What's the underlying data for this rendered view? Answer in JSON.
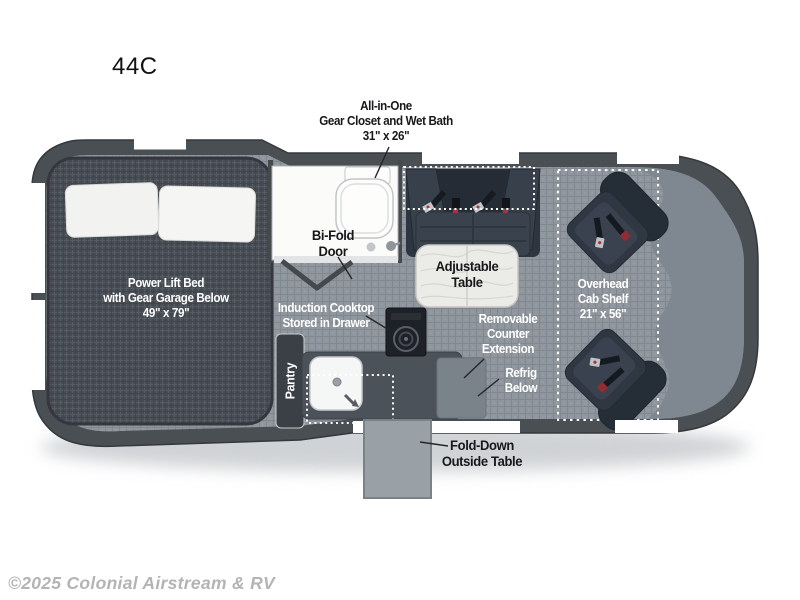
{
  "plan_code": "44C",
  "watermark": {
    "text": "©2025 Colonial Airstream & RV"
  },
  "colors": {
    "van_body": "#4a4f54",
    "floor": "#8f969e",
    "bed": "#474c53",
    "furniture_dark": "#2f3742",
    "bath_white": "#fbfbfa",
    "table_light": "#ebebe8",
    "label_white": "#ffffff",
    "label_dark": "#17181a",
    "watermark_gray": "#b4b4b4",
    "belt_red": "#a8343a"
  },
  "labels": {
    "closet": {
      "line1": "All-in-One",
      "line2": "Gear Closet and Wet Bath",
      "line3": "31\" x 26\""
    },
    "bed": {
      "line1": "Power Lift Bed",
      "line2": "with Gear Garage Below",
      "line3": "49\" x 79\""
    },
    "bifold": {
      "line1": "Bi-Fold",
      "line2": "Door"
    },
    "table": {
      "line1": "Adjustable",
      "line2": "Table"
    },
    "cab_shelf": {
      "line1": "Overhead",
      "line2": "Cab Shelf",
      "line3": "21\" x 56\""
    },
    "cooktop": {
      "line1": "Induction Cooktop",
      "line2": "Stored in Drawer"
    },
    "pantry": "Pantry",
    "counter_extension": {
      "line1": "Removable",
      "line2": "Counter",
      "line3": "Extension"
    },
    "refrig": {
      "line1": "Refrig",
      "line2": "Below"
    },
    "outside_table": {
      "line1": "Fold-Down",
      "line2": "Outside Table"
    }
  }
}
